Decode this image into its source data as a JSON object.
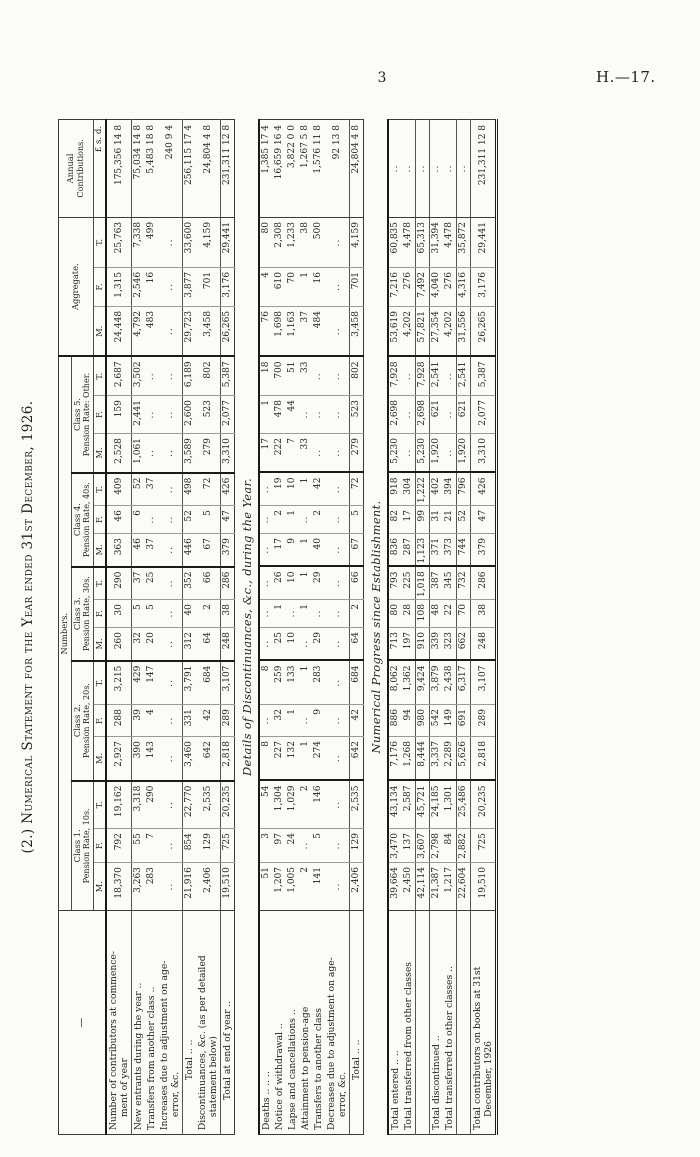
{
  "page": {
    "page_number": "3",
    "doc_ref": "H.—17.",
    "title": "(2.) Numerical Statement for the Year ended 31st December, 1926."
  },
  "table": {
    "stub_dash": "—",
    "numbers_label": "Numbers.",
    "mft": [
      "M.",
      "F.",
      "T."
    ],
    "lsd": "£ s. d.",
    "class_groups": [
      {
        "line1": "Class 1.",
        "line2": "Pension Rate, 10s."
      },
      {
        "line1": "Class 2.",
        "line2": "Pension Rate, 20s."
      },
      {
        "line1": "Class 3.",
        "line2": "Pension Rate, 30s."
      },
      {
        "line1": "Class 4.",
        "line2": "Pension Rate, 40s."
      },
      {
        "line1": "Class 5.",
        "line2": "Pension Rate: Other."
      }
    ],
    "aggregate_label": "Aggregate.",
    "annual_label_line1": "Annual",
    "annual_label_line2": "Contributions."
  },
  "sections": [
    {
      "caption": null,
      "rows": [
        {
          "label": [
            "Number of contributors at commence-",
            "ment of year"
          ],
          "indent": 0,
          "rule": false,
          "cells": [
            "18,370",
            "792",
            "19,162",
            "2,927",
            "288",
            "3,215",
            "260",
            "30",
            "290",
            "363",
            "46",
            "409",
            "2,528",
            "159",
            "2,687",
            "24,448",
            "1,315",
            "25,763",
            "175,356 14 8"
          ]
        },
        {
          "label": [
            "New entrants during the year  .."
          ],
          "indent": 0,
          "rule": true,
          "cells": [
            "3,263",
            "55",
            "3,318",
            "390",
            "39",
            "429",
            "32",
            "5",
            "37",
            "46",
            "6",
            "52",
            "1,061",
            "2,441",
            "3,502",
            "4,792",
            "2,546",
            "7,338",
            "75,034 14 8"
          ]
        },
        {
          "label": [
            "Transfers from another class  .."
          ],
          "indent": 0,
          "rule": false,
          "cells": [
            "283",
            "7",
            "290",
            "143",
            "4",
            "147",
            "20",
            "5",
            "25",
            "37",
            "..",
            "37",
            "..",
            "..",
            "..",
            "483",
            "16",
            "499",
            "5,483 18 8"
          ]
        },
        {
          "label": [
            "Increases due to adjustment on age-",
            "error, &c."
          ],
          "indent": 0,
          "rule": false,
          "cells": [
            "..",
            "..",
            "..",
            "..",
            "..",
            "..",
            "..",
            "..",
            "..",
            "..",
            "..",
            "..",
            "..",
            "..",
            "..",
            "..",
            "..",
            "..",
            "240 9 4"
          ]
        },
        {
          "label": [
            "Total  ..  .."
          ],
          "indent": 5,
          "rule": true,
          "cells": [
            "21,916",
            "854",
            "22,770",
            "3,460",
            "331",
            "3,791",
            "312",
            "40",
            "352",
            "446",
            "52",
            "498",
            "3,589",
            "2,600",
            "6,189",
            "29,723",
            "3,877",
            "33,600",
            "256,115 17 4"
          ]
        },
        {
          "label": [
            "Discontinuances, &c. (as per detailed",
            "statement below)"
          ],
          "indent": 0,
          "rule": false,
          "cells": [
            "2,406",
            "129",
            "2,535",
            "642",
            "42",
            "684",
            "64",
            "2",
            "66",
            "67",
            "5",
            "72",
            "279",
            "523",
            "802",
            "3,458",
            "701",
            "4,159",
            "24,804 4 8"
          ]
        },
        {
          "label": [
            "Total at end of year  .."
          ],
          "indent": 3,
          "rule": true,
          "cells": [
            "19,510",
            "725",
            "20,235",
            "2,818",
            "289",
            "3,107",
            "248",
            "38",
            "286",
            "379",
            "47",
            "426",
            "3,310",
            "2,077",
            "5,387",
            "26,265",
            "3,176",
            "29,441",
            "231,311 12 8"
          ]
        }
      ]
    },
    {
      "caption": "Details of Discontinuances, &c., during the Year.",
      "rows": [
        {
          "label": [
            "Deaths ..  ..  .."
          ],
          "indent": 0,
          "rule": false,
          "cells": [
            "51",
            "3",
            "54",
            "8",
            "..",
            "8",
            "..",
            "..",
            "..",
            "..",
            "..",
            "..",
            "17",
            "1",
            "18",
            "76",
            "4",
            "80",
            "1,385 17 4"
          ]
        },
        {
          "label": [
            "Notice of withdrawal  .."
          ],
          "indent": 0,
          "rule": false,
          "cells": [
            "1,207",
            "97",
            "1,304",
            "227",
            "32",
            "259",
            "25",
            "1",
            "26",
            "17",
            "2",
            "19",
            "222",
            "478",
            "700",
            "1,698",
            "610",
            "2,308",
            "16,659 16 4"
          ]
        },
        {
          "label": [
            "Lapse and cancellations  .."
          ],
          "indent": 0,
          "rule": false,
          "cells": [
            "1,005",
            "24",
            "1,029",
            "132",
            "1",
            "133",
            "10",
            "..",
            "10",
            "9",
            "1",
            "10",
            "7",
            "44",
            "51",
            "1,163",
            "70",
            "1,233",
            "3,822 0 0"
          ]
        },
        {
          "label": [
            "Attainment to pension-age"
          ],
          "indent": 0,
          "rule": false,
          "cells": [
            "2",
            "..",
            "2",
            "1",
            "..",
            "1",
            "..",
            "1",
            "1",
            "1",
            "..",
            "1",
            "33",
            "..",
            "33",
            "37",
            "1",
            "38",
            "1,267 5 8"
          ]
        },
        {
          "label": [
            "Transfers to another class"
          ],
          "indent": 0,
          "rule": false,
          "cells": [
            "141",
            "5",
            "146",
            "274",
            "9",
            "283",
            "29",
            "..",
            "29",
            "40",
            "2",
            "42",
            "..",
            "..",
            "..",
            "484",
            "16",
            "500",
            "1,576 11 8"
          ]
        },
        {
          "label": [
            "Decreases due to adjustment on age-",
            "error, &c."
          ],
          "indent": 0,
          "rule": false,
          "cells": [
            "..",
            "..",
            "..",
            "..",
            "..",
            "..",
            "..",
            "..",
            "..",
            "..",
            "..",
            "..",
            "..",
            "..",
            "..",
            "..",
            "..",
            "..",
            "92 13 8"
          ]
        },
        {
          "label": [
            "Total  ..  .."
          ],
          "indent": 5,
          "rule": true,
          "cells": [
            "2,406",
            "129",
            "2,535",
            "642",
            "42",
            "684",
            "64",
            "2",
            "66",
            "67",
            "5",
            "72",
            "279",
            "523",
            "802",
            "3,458",
            "701",
            "4,159",
            "24,804 4 8"
          ]
        }
      ]
    },
    {
      "caption": "Numerical Progress since Establishment.",
      "rows": [
        {
          "label": [
            "Total entered  ..  .."
          ],
          "indent": 0,
          "rule": false,
          "cells": [
            "39,664",
            "3,470",
            "43,134",
            "7,176",
            "886",
            "8,062",
            "713",
            "80",
            "793",
            "836",
            "82",
            "918",
            "5,230",
            "2,698",
            "7,928",
            "53,619",
            "7,216",
            "60,835",
            ".."
          ]
        },
        {
          "label": [
            "Total transferred from other classes"
          ],
          "indent": 0,
          "rule": false,
          "cells": [
            "2,450",
            "137",
            "2,587",
            "1,268",
            "94",
            "1,362",
            "197",
            "28",
            "225",
            "287",
            "17",
            "304",
            "..",
            "..",
            "..",
            "4,202",
            "276",
            "4,478",
            ".."
          ]
        },
        {
          "label": [
            ""
          ],
          "indent": 0,
          "rule": true,
          "cells": [
            "42,114",
            "3,607",
            "45,721",
            "8,444",
            "980",
            "9,424",
            "910",
            "108",
            "1,018",
            "1,123",
            "99",
            "1,222",
            "5,230",
            "2,698",
            "7,928",
            "57,821",
            "7,492",
            "65,313",
            ".."
          ]
        },
        {
          "label": [
            "Total discontinued  .."
          ],
          "indent": 0,
          "rule": true,
          "cells": [
            "21,387",
            "2,798",
            "24,185",
            "3,337",
            "542",
            "3,879",
            "339",
            "48",
            "387",
            "371",
            "31",
            "402",
            "1,920",
            "621",
            "2,541",
            "27,354",
            "4,040",
            "31,394",
            ".."
          ]
        },
        {
          "label": [
            "Total transferred to other classes  .."
          ],
          "indent": 0,
          "rule": false,
          "cells": [
            "1,217",
            "84",
            "1,301",
            "2,289",
            "149",
            "2,438",
            "323",
            "22",
            "345",
            "373",
            "21",
            "394",
            "..",
            "..",
            "..",
            "4,202",
            "276",
            "4,478",
            ".."
          ]
        },
        {
          "label": [
            ""
          ],
          "indent": 0,
          "rule": true,
          "cells": [
            "22,604",
            "2,882",
            "25,486",
            "5,626",
            "691",
            "6,317",
            "662",
            "70",
            "732",
            "744",
            "52",
            "796",
            "1,920",
            "621",
            "2,541",
            "31,556",
            "4,316",
            "35,872",
            ".."
          ]
        },
        {
          "label": [
            "Total contributors on books at 31st",
            "December, 1926"
          ],
          "indent": 0,
          "rule": true,
          "cells": [
            "19,510",
            "725",
            "20,235",
            "2,818",
            "289",
            "3,107",
            "248",
            "38",
            "286",
            "379",
            "47",
            "426",
            "3,310",
            "2,077",
            "5,387",
            "26,265",
            "3,176",
            "29,441",
            "231,311 12 8"
          ]
        }
      ]
    }
  ]
}
